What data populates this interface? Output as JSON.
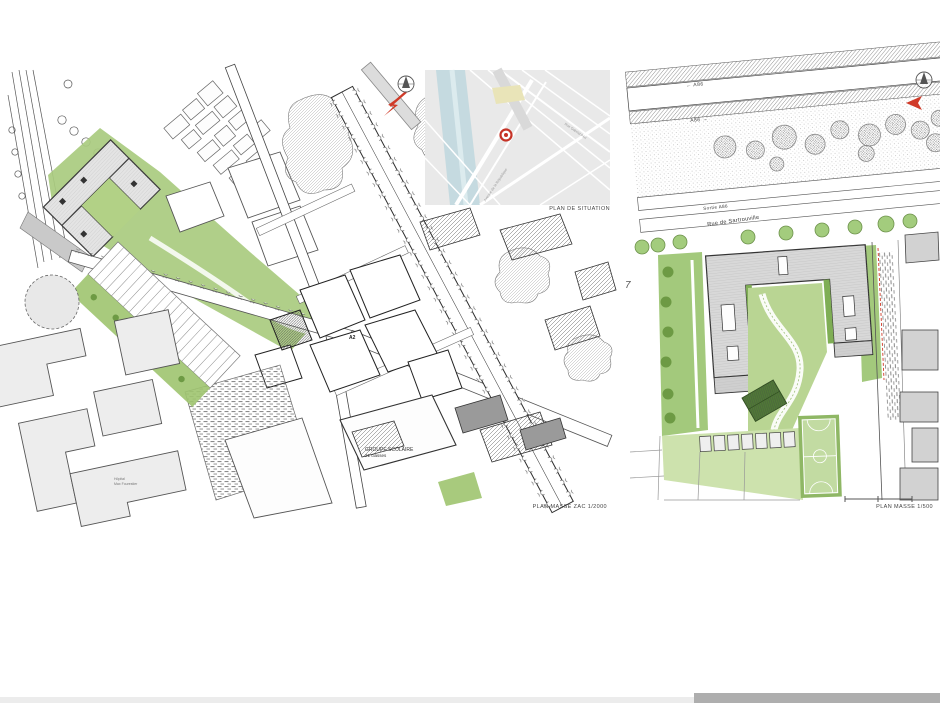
{
  "captions": {
    "plan_situation": "PLAN DE SITUATION",
    "plan_masse_zac": "PLAN MASSE ZAC 1/2000",
    "plan_masse_500": "PLAN MASSE 1/500"
  },
  "left_plan": {
    "labels": {
      "groupe_scolaire": "GROUPE SCOLAIRE",
      "groupe_scolaire_sub": "21 classes",
      "block_a2": "A2",
      "hopital_1": "Hôpital",
      "hopital_2": "Max Fourestier"
    }
  },
  "situation_map": {
    "streets": {
      "gabriel_peri": "Rue Gabriel Péri",
      "republique": "Avenue de la République"
    }
  },
  "right_plan": {
    "labels": {
      "a86_west": "←  A86",
      "a86_east": "A86  →",
      "sortie_a86": "Sortie A86",
      "rue_sartrouville": "Rue de Sartrouville"
    }
  },
  "page": {
    "stray_number": "7"
  },
  "colors": {
    "accent_red": "#d03a28",
    "green_canopy": "#8fbe6a",
    "green_lawn": "#c9dfa9",
    "green_dark": "#6d9a44",
    "map_water": "#c5dae0",
    "building_gray": "#d8d8d8"
  }
}
